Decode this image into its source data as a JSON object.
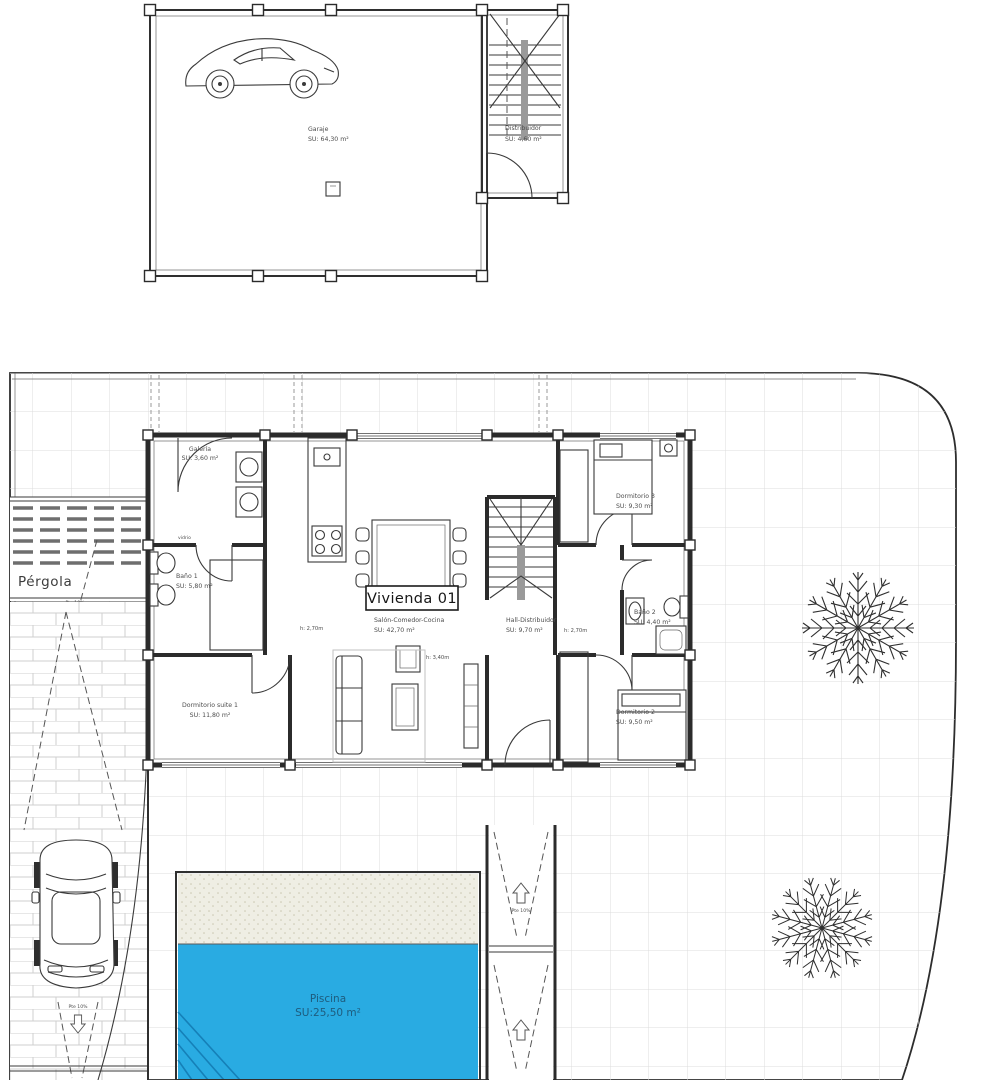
{
  "upper_plan": {
    "garage": {
      "name": "Garaje",
      "area": "SU: 64,30 m²"
    },
    "distributor": {
      "name": "Distribuidor",
      "area": "SU: 4,60 m²"
    }
  },
  "ground_plan": {
    "tag": "Vivienda 01",
    "galeria": {
      "name": "Galería",
      "area": "SU: 3,60 m²"
    },
    "bano1": {
      "name": "Baño 1",
      "area": "SU: 5,80 m²"
    },
    "suite": {
      "name": "Dormitorio suite 1",
      "area": "SU: 11,80 m²"
    },
    "salon": {
      "name": "Salón-Comedor-Cocina",
      "area": "SU: 42,70 m²"
    },
    "hall": {
      "name": "Hall-Distribuidor",
      "area": "SU: 9,70 m²"
    },
    "dorm3": {
      "name": "Dormitorio 3",
      "area": "SU: 9,30 m²"
    },
    "bano2": {
      "name": "Baño 2",
      "area": "SU: 4,40 m²"
    },
    "dorm2": {
      "name": "Dormitorio 2",
      "area": "SU: 9,50 m²"
    },
    "pergola": "Pérgola",
    "pool": {
      "name": "Piscina",
      "area": "SU:25,50 m²"
    },
    "notes": {
      "h270": "h: 2,70m",
      "h340": "h: 3,40m",
      "slope": "Pte 10%",
      "glass": "vidrio"
    }
  },
  "colors": {
    "pool_water": "#29ABE2",
    "pool_sand": "#EFEEE4",
    "pool_text": "#1E5C7E",
    "tile_line": "#DCDCDC"
  }
}
